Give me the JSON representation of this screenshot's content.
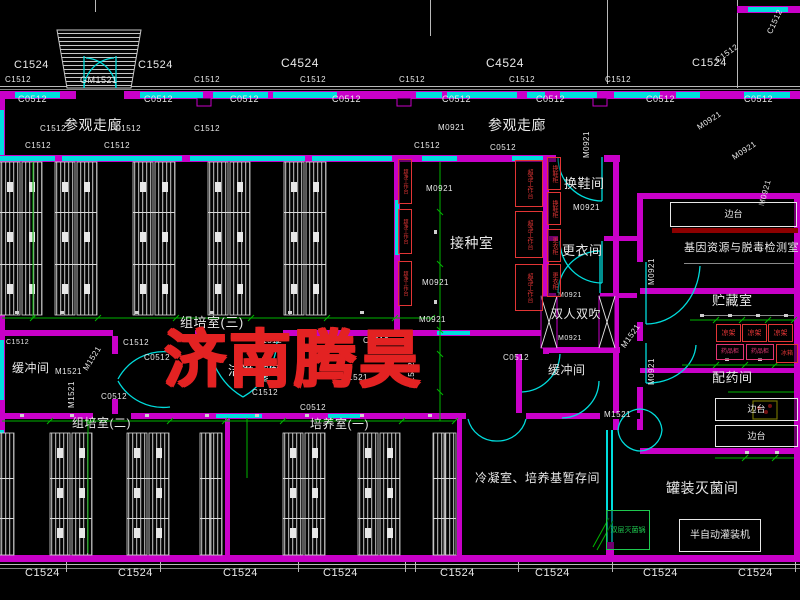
{
  "watermark": {
    "text": "济南腾昊"
  },
  "palette": {
    "background": "#000000",
    "wall": "#c800c8",
    "window": "#00dede",
    "dimension": "#00b400",
    "line": "#c8c8c8",
    "watermark": "#e32222",
    "equipment_text": "#e23535",
    "bench_bar": "#8c0000",
    "sink": "#c8c800"
  },
  "overlays": [
    {
      "t": "C1524",
      "x": 14,
      "y": 60,
      "fs": 11,
      "n": "window-code"
    },
    {
      "t": "C1524",
      "x": 138,
      "y": 60,
      "fs": 11,
      "n": "window-code"
    },
    {
      "t": "C4524",
      "x": 281,
      "y": 57,
      "fs": 12,
      "n": "window-code"
    },
    {
      "t": "C4524",
      "x": 486,
      "y": 57,
      "fs": 12,
      "n": "window-code"
    },
    {
      "t": "C1524",
      "x": 692,
      "y": 58,
      "fs": 11,
      "n": "window-code"
    },
    {
      "t": "C1512",
      "x": 5,
      "y": 76,
      "fs": 8,
      "n": "window-code"
    },
    {
      "t": "C1512",
      "x": 194,
      "y": 76,
      "fs": 8,
      "n": "window-code"
    },
    {
      "t": "C1512",
      "x": 300,
      "y": 76,
      "fs": 8,
      "n": "window-code"
    },
    {
      "t": "C1512",
      "x": 399,
      "y": 76,
      "fs": 8,
      "n": "window-code"
    },
    {
      "t": "C1512",
      "x": 509,
      "y": 76,
      "fs": 8,
      "n": "window-code"
    },
    {
      "t": "C1512",
      "x": 605,
      "y": 76,
      "fs": 8,
      "n": "window-code"
    },
    {
      "t": "C1512",
      "x": 714,
      "y": 58,
      "fs": 8,
      "rot": -35,
      "n": "window-code"
    },
    {
      "t": "C1512",
      "x": 766,
      "y": 32,
      "fs": 8,
      "rot": -65,
      "n": "window-code"
    },
    {
      "t": "GM1521",
      "x": 80,
      "y": 76,
      "fs": 9,
      "n": "door-code"
    },
    {
      "t": "C0512",
      "x": 18,
      "y": 95,
      "fs": 9,
      "n": "window-code"
    },
    {
      "t": "C0512",
      "x": 144,
      "y": 95,
      "fs": 9,
      "n": "window-code"
    },
    {
      "t": "C0512",
      "x": 230,
      "y": 95,
      "fs": 9,
      "n": "window-code"
    },
    {
      "t": "C0512",
      "x": 332,
      "y": 95,
      "fs": 9,
      "n": "window-code"
    },
    {
      "t": "C0512",
      "x": 442,
      "y": 95,
      "fs": 9,
      "n": "window-code"
    },
    {
      "t": "C0512",
      "x": 536,
      "y": 95,
      "fs": 9,
      "n": "window-code"
    },
    {
      "t": "C0512",
      "x": 646,
      "y": 95,
      "fs": 9,
      "n": "window-code"
    },
    {
      "t": "C0512",
      "x": 744,
      "y": 95,
      "fs": 9,
      "n": "window-code"
    },
    {
      "t": "参观走廊",
      "x": 64,
      "y": 118,
      "fs": 14,
      "n": "room-label"
    },
    {
      "t": "参观走廊",
      "x": 488,
      "y": 118,
      "fs": 14,
      "n": "room-label"
    },
    {
      "t": "C1512",
      "x": 40,
      "y": 125,
      "fs": 8,
      "n": "window-code"
    },
    {
      "t": "C1512",
      "x": 115,
      "y": 125,
      "fs": 8,
      "n": "window-code"
    },
    {
      "t": "C1512",
      "x": 194,
      "y": 125,
      "fs": 8,
      "n": "window-code"
    },
    {
      "t": "M0921",
      "x": 438,
      "y": 124,
      "fs": 8,
      "n": "door-code"
    },
    {
      "t": "C1512",
      "x": 25,
      "y": 142,
      "fs": 8,
      "n": "window-code"
    },
    {
      "t": "C1512",
      "x": 104,
      "y": 142,
      "fs": 8,
      "n": "window-code"
    },
    {
      "t": "C1512",
      "x": 414,
      "y": 142,
      "fs": 8,
      "n": "window-code"
    },
    {
      "t": "C0512",
      "x": 490,
      "y": 144,
      "fs": 8,
      "n": "window-code"
    },
    {
      "t": "M0921",
      "x": 583,
      "y": 158,
      "fs": 8,
      "rot": -90,
      "n": "door-code"
    },
    {
      "t": "M0921",
      "x": 696,
      "y": 125,
      "fs": 8,
      "rot": -33,
      "n": "door-code"
    },
    {
      "t": "M0921",
      "x": 731,
      "y": 155,
      "fs": 8,
      "rot": -33,
      "n": "door-code"
    },
    {
      "t": "M0921",
      "x": 758,
      "y": 205,
      "fs": 8,
      "rot": -75,
      "n": "door-code"
    },
    {
      "t": "换鞋间",
      "x": 564,
      "y": 177,
      "fs": 13,
      "n": "room-label"
    },
    {
      "t": "M0921",
      "x": 573,
      "y": 204,
      "fs": 8,
      "n": "door-code"
    },
    {
      "t": "更衣间",
      "x": 562,
      "y": 244,
      "fs": 13,
      "n": "room-label"
    },
    {
      "t": "接种室",
      "x": 450,
      "y": 236,
      "fs": 14,
      "n": "room-label"
    },
    {
      "t": "M0921",
      "x": 426,
      "y": 185,
      "fs": 8,
      "n": "door-code"
    },
    {
      "t": "M0921",
      "x": 422,
      "y": 279,
      "fs": 8,
      "n": "door-code"
    },
    {
      "t": "M0921",
      "x": 419,
      "y": 316,
      "fs": 8,
      "n": "door-code"
    },
    {
      "t": "组培室(三)",
      "x": 180,
      "y": 316,
      "fs": 13,
      "n": "room-label"
    },
    {
      "t": "M1521",
      "x": 191,
      "y": 335,
      "fs": 8,
      "n": "door-code"
    },
    {
      "t": "C1512",
      "x": 256,
      "y": 337,
      "fs": 8,
      "n": "window-code"
    },
    {
      "t": "M1521",
      "x": 309,
      "y": 336,
      "fs": 8,
      "n": "door-code"
    },
    {
      "t": "C1512",
      "x": 363,
      "y": 337,
      "fs": 8,
      "n": "window-code"
    },
    {
      "t": "C1512",
      "x": 123,
      "y": 339,
      "fs": 8,
      "n": "window-code"
    },
    {
      "t": "C1512",
      "x": 6,
      "y": 339,
      "fs": 7,
      "n": "window-code"
    },
    {
      "t": "C0512",
      "x": 144,
      "y": 354,
      "fs": 8,
      "n": "window-code"
    },
    {
      "t": "缓冲间",
      "x": 12,
      "y": 362,
      "fs": 12,
      "n": "room-label"
    },
    {
      "t": "M1521",
      "x": 55,
      "y": 368,
      "fs": 8,
      "n": "door-code"
    },
    {
      "t": "M1521",
      "x": 68,
      "y": 408,
      "fs": 8,
      "rot": -90,
      "n": "door-code"
    },
    {
      "t": "M1521",
      "x": 82,
      "y": 368,
      "fs": 8,
      "rot": -58,
      "n": "door-code"
    },
    {
      "t": "M1521",
      "x": 262,
      "y": 382,
      "fs": 8,
      "rot": -90,
      "n": "door-code"
    },
    {
      "t": "洁净走廊",
      "x": 228,
      "y": 364,
      "fs": 13,
      "n": "room-label"
    },
    {
      "t": "M1521",
      "x": 341,
      "y": 374,
      "fs": 8,
      "n": "door-code"
    },
    {
      "t": "C1512",
      "x": 252,
      "y": 389,
      "fs": 8,
      "n": "window-code"
    },
    {
      "t": "C0512",
      "x": 101,
      "y": 393,
      "fs": 8,
      "n": "window-code"
    },
    {
      "t": "C0512",
      "x": 300,
      "y": 404,
      "fs": 8,
      "n": "window-code"
    },
    {
      "t": "双人双吹",
      "x": 551,
      "y": 308,
      "fs": 12,
      "n": "room-label"
    },
    {
      "t": "M0921",
      "x": 558,
      "y": 292,
      "fs": 7,
      "n": "door-code"
    },
    {
      "t": "M0921",
      "x": 558,
      "y": 335,
      "fs": 7,
      "n": "door-code"
    },
    {
      "t": "缓冲间",
      "x": 548,
      "y": 364,
      "fs": 12,
      "n": "room-label"
    },
    {
      "t": "M0921",
      "x": 648,
      "y": 285,
      "fs": 8,
      "rot": -90,
      "n": "door-code"
    },
    {
      "t": "M0921",
      "x": 648,
      "y": 385,
      "fs": 8,
      "rot": -90,
      "n": "door-code"
    },
    {
      "t": "M1521",
      "x": 620,
      "y": 345,
      "fs": 8,
      "rot": -55,
      "n": "door-code"
    },
    {
      "t": "M1521",
      "x": 604,
      "y": 411,
      "fs": 8,
      "n": "door-code"
    },
    {
      "t": "C0512",
      "x": 503,
      "y": 354,
      "fs": 8,
      "n": "window-code"
    },
    {
      "t": "C1512",
      "x": 408,
      "y": 388,
      "fs": 8,
      "rot": -90,
      "n": "window-code"
    },
    {
      "t": "基因资源与脱毒检测室",
      "x": 684,
      "y": 243,
      "fs": 11,
      "n": "room-label"
    },
    {
      "t": "贮藏室",
      "x": 712,
      "y": 294,
      "fs": 13,
      "n": "room-label"
    },
    {
      "t": "配药间",
      "x": 712,
      "y": 371,
      "fs": 13,
      "n": "room-label"
    },
    {
      "t": "罐装灭菌间",
      "x": 666,
      "y": 481,
      "fs": 14,
      "n": "room-label"
    },
    {
      "t": "冷凝室、培养基暂存间",
      "x": 475,
      "y": 472,
      "fs": 12,
      "n": "room-label"
    },
    {
      "t": "培养室(一)",
      "x": 310,
      "y": 418,
      "fs": 12,
      "n": "room-label"
    },
    {
      "t": "组培室(二)",
      "x": 72,
      "y": 417,
      "fs": 12,
      "n": "room-label"
    },
    {
      "t": "C1524",
      "x": 25,
      "y": 568,
      "fs": 11,
      "n": "window-code"
    },
    {
      "t": "C1524",
      "x": 118,
      "y": 568,
      "fs": 11,
      "n": "window-code"
    },
    {
      "t": "C1524",
      "x": 223,
      "y": 568,
      "fs": 11,
      "n": "window-code"
    },
    {
      "t": "C1524",
      "x": 323,
      "y": 568,
      "fs": 11,
      "n": "window-code"
    },
    {
      "t": "C1524",
      "x": 440,
      "y": 568,
      "fs": 11,
      "n": "window-code"
    },
    {
      "t": "C1524",
      "x": 535,
      "y": 568,
      "fs": 11,
      "n": "window-code"
    },
    {
      "t": "C1524",
      "x": 643,
      "y": 568,
      "fs": 11,
      "n": "window-code"
    },
    {
      "t": "C1524",
      "x": 738,
      "y": 568,
      "fs": 11,
      "n": "window-code"
    },
    {
      "t": "超净工作台",
      "x": 515,
      "y": 160,
      "w": 28,
      "h": 47,
      "fs": 6,
      "cls": "box b-cyan t-red vert",
      "n": "clean-bench"
    },
    {
      "t": "超净工作台",
      "x": 515,
      "y": 211,
      "w": 28,
      "h": 47,
      "fs": 6,
      "cls": "box b-cyan t-red vert",
      "n": "clean-bench"
    },
    {
      "t": "超净工作台",
      "x": 515,
      "y": 264,
      "w": 28,
      "h": 47,
      "fs": 6,
      "cls": "box b-cyan t-red vert",
      "n": "clean-bench"
    },
    {
      "t": "超净工作台",
      "x": 398,
      "y": 159,
      "w": 14,
      "h": 45,
      "fs": 5,
      "cls": "box b-cyan t-red vert",
      "n": "clean-bench"
    },
    {
      "t": "超净工作台",
      "x": 398,
      "y": 209,
      "w": 14,
      "h": 45,
      "fs": 5,
      "cls": "box b-cyan t-red vert",
      "n": "clean-bench"
    },
    {
      "t": "超净工作台",
      "x": 398,
      "y": 261,
      "w": 14,
      "h": 45,
      "fs": 5,
      "cls": "box b-cyan t-red vert",
      "n": "clean-bench"
    },
    {
      "t": "换鞋柜",
      "x": 547,
      "y": 157,
      "w": 14,
      "h": 33,
      "fs": 6,
      "cls": "box b-mag t-red vert",
      "n": "shoe-cabinet"
    },
    {
      "t": "换鞋柜",
      "x": 547,
      "y": 192,
      "w": 14,
      "h": 33,
      "fs": 6,
      "cls": "box b-mag t-red vert",
      "n": "shoe-cabinet"
    },
    {
      "t": "更衣柜",
      "x": 547,
      "y": 229,
      "w": 14,
      "h": 33,
      "fs": 6,
      "cls": "box b-mag t-red vert",
      "n": "clothes-cabinet"
    },
    {
      "t": "更衣柜",
      "x": 547,
      "y": 264,
      "w": 14,
      "h": 33,
      "fs": 6,
      "cls": "box b-mag t-red vert",
      "n": "clothes-cabinet"
    },
    {
      "t": "凉架",
      "x": 716,
      "y": 324,
      "w": 25,
      "h": 18,
      "fs": 7,
      "cls": "box b-cyan t-red",
      "n": "cooling-rack"
    },
    {
      "t": "凉架",
      "x": 742,
      "y": 324,
      "w": 25,
      "h": 18,
      "fs": 7,
      "cls": "box b-cyan t-red",
      "n": "cooling-rack"
    },
    {
      "t": "凉架",
      "x": 768,
      "y": 324,
      "w": 25,
      "h": 18,
      "fs": 7,
      "cls": "box b-cyan t-red",
      "n": "cooling-rack"
    },
    {
      "t": "药品柜",
      "x": 716,
      "y": 344,
      "w": 28,
      "h": 16,
      "fs": 6,
      "cls": "box b-cyan t-mag",
      "n": "medicine-cabinet"
    },
    {
      "t": "药品柜",
      "x": 746,
      "y": 344,
      "w": 28,
      "h": 16,
      "fs": 6,
      "cls": "box b-cyan t-mag",
      "n": "medicine-cabinet"
    },
    {
      "t": "冰箱",
      "x": 776,
      "y": 344,
      "w": 22,
      "h": 19,
      "fs": 6,
      "cls": "box b-green t-red",
      "n": "fridge"
    },
    {
      "t": "边台",
      "x": 670,
      "y": 202,
      "w": 127,
      "h": 25,
      "fs": 9,
      "cls": "box b-mag t-white",
      "n": "side-bench"
    },
    {
      "t": "边台",
      "x": 715,
      "y": 398,
      "w": 83,
      "h": 23,
      "fs": 9,
      "cls": "box b-red t-white",
      "n": "side-bench"
    },
    {
      "t": "边台",
      "x": 715,
      "y": 425,
      "w": 83,
      "h": 22,
      "fs": 9,
      "cls": "box b-red t-white",
      "n": "side-bench"
    },
    {
      "t": "半自动灌装机",
      "x": 679,
      "y": 519,
      "w": 82,
      "h": 33,
      "fs": 10,
      "cls": "box b-dash t-white",
      "n": "filling-machine"
    },
    {
      "t": "双层灭菌锅",
      "x": 606,
      "y": 510,
      "w": 44,
      "h": 40,
      "fs": 7,
      "cls": "box b-green t-green",
      "n": "sterilizer"
    }
  ]
}
